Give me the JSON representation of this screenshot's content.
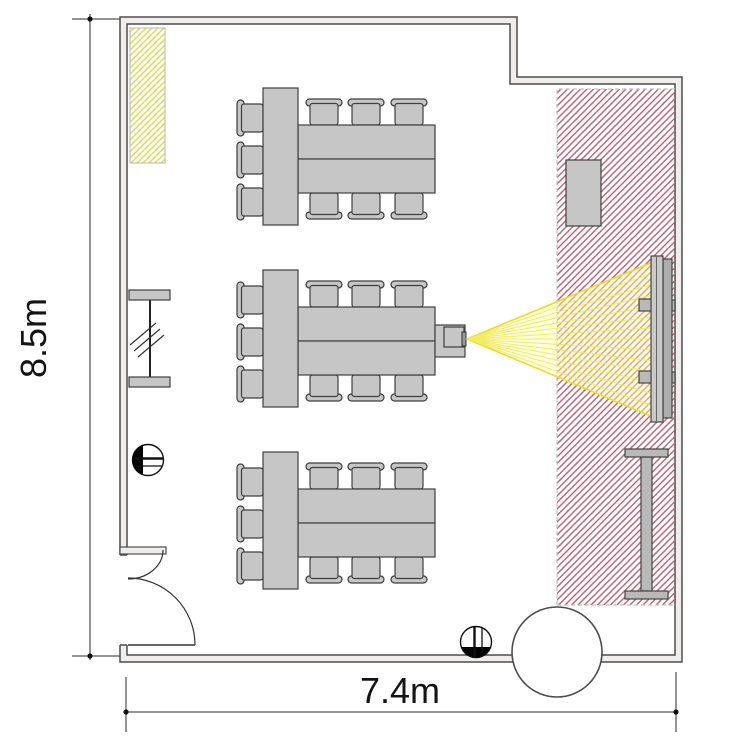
{
  "title": "Classroom floor plan",
  "plan": {
    "dimensions": {
      "height_label": "8.5m",
      "width_label": "7.4m"
    },
    "counts": {
      "table_groups": 3,
      "chairs_per_group": 9,
      "total_chairs": 27
    },
    "elements": [
      "walls with stepped top-right corner",
      "entrance door with swing arcs (bottom-left)",
      "three table groups: head table + two long tables + nine chairs",
      "projector mounted at end of middle table group",
      "yellow projection cone toward wall screen",
      "wall-mounted screen with brackets (right wall)",
      "cabinet (top right)",
      "tall standing table (right)",
      "round table (bottom, on wall)",
      "radiator on left wall",
      "two round wall marker symbols",
      "yellow hatched zone (top left)",
      "red hatched zone (right side)"
    ],
    "colors": {
      "background": "#ffffff",
      "wall_fill": "#efeeec",
      "wall_line": "#4d4d4d",
      "furniture_fill": "#c6c6c6",
      "furniture_line": "#3f3f3f",
      "yellow_hatch": "#d8dc55",
      "red_hatch": "#b36577",
      "cone_yellow": "#eed92e"
    }
  }
}
